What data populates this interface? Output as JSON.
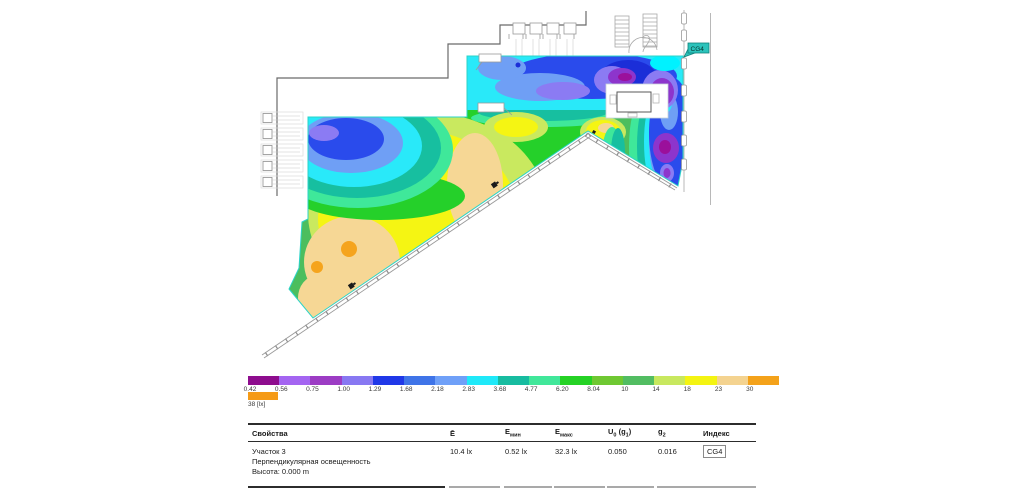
{
  "plan": {
    "tag": "CG4",
    "tag_color": "#2CC3BB"
  },
  "legend": {
    "overflow_label": "38 [lx]",
    "overflow_color": "#F59A16",
    "segments": [
      {
        "label": "0.42",
        "color": "#8E0D8E"
      },
      {
        "label": "0.56",
        "color": "#A465F1"
      },
      {
        "label": "0.75",
        "color": "#9C3CC4"
      },
      {
        "label": "1.00",
        "color": "#8878F2"
      },
      {
        "label": "1.29",
        "color": "#2038E8"
      },
      {
        "label": "1.68",
        "color": "#3F74E8"
      },
      {
        "label": "2.18",
        "color": "#6FA0F8"
      },
      {
        "label": "2.83",
        "color": "#1FE9F9"
      },
      {
        "label": "3.68",
        "color": "#17BCA0"
      },
      {
        "label": "4.77",
        "color": "#41E79A"
      },
      {
        "label": "6.20",
        "color": "#25D225"
      },
      {
        "label": "8.04",
        "color": "#6FC832"
      },
      {
        "label": "10",
        "color": "#52BD62"
      },
      {
        "label": "14",
        "color": "#C8E85F"
      },
      {
        "label": "18",
        "color": "#F4F412"
      },
      {
        "label": "23",
        "color": "#F4D390"
      },
      {
        "label": "30",
        "color": "#F4A21A"
      }
    ]
  },
  "table": {
    "headers": {
      "properties": "Свойства",
      "e_avg": "Ē",
      "e_min_base": "E",
      "e_min_sub": "мин",
      "e_max_base": "E",
      "e_max_sub": "макс",
      "u0_p1": "U",
      "u0_s1": "0",
      "u0_p2": " (g",
      "u0_s2": "1",
      "u0_p3": ")",
      "g2_base": "g",
      "g2_sub": "2",
      "index": "Индекс"
    },
    "row": {
      "name": "Участок 3",
      "metric": "Перпендикулярная освещенность",
      "height": "Высота: 0.000 m",
      "e_avg": "10.4 lx",
      "e_min": "0.52 lx",
      "e_max": "32.3 lx",
      "u0": "0.050",
      "g2": "0.016",
      "index": "CG4"
    }
  },
  "chart_data": {
    "type": "heatmap",
    "title": "Участок 3",
    "subtitle": "Перпендикулярная освещенность",
    "measurement_plane": "Высота: 0.000 m",
    "unit": "lx",
    "scale_levels_lx": [
      0.42,
      0.56,
      0.75,
      1.0,
      1.29,
      1.68,
      2.18,
      2.83,
      3.68,
      4.77,
      6.2,
      8.04,
      10,
      14,
      18,
      23,
      30,
      38
    ],
    "stats": {
      "E_avg_lx": 10.4,
      "E_min_lx": 0.52,
      "E_max_lx": 32.3,
      "U0_g1": 0.05,
      "g2": 0.016,
      "index": "CG4"
    },
    "legend_position": "bottom",
    "notes": "False-colour iso-illuminance plot over a building floor plan; dark blue/purple minima in upper-right, orange maxima (~30+ lx) in lower-left; calculation surface tagged CG4"
  }
}
